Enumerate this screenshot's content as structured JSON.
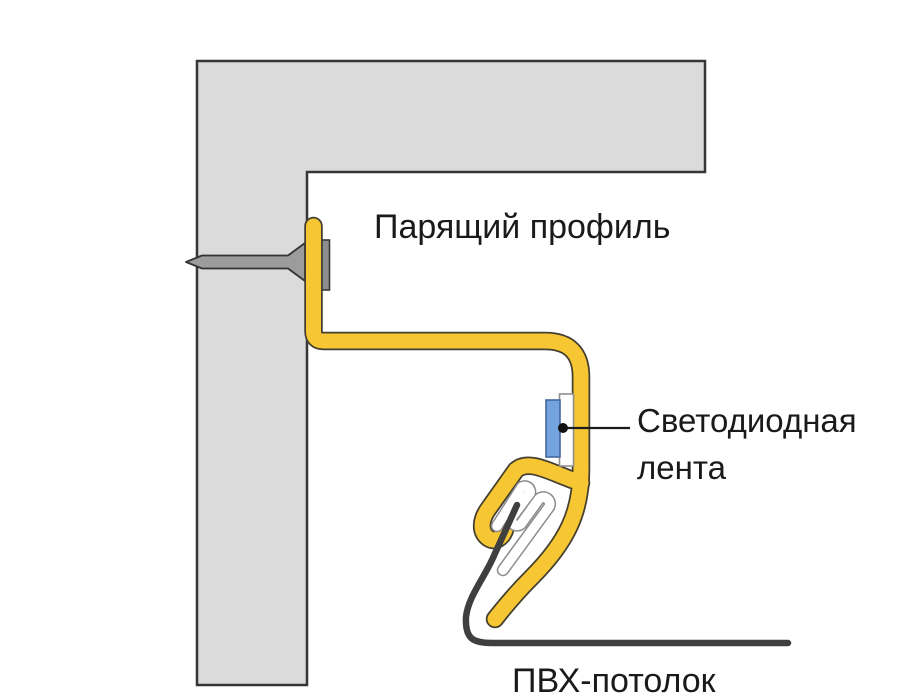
{
  "diagram": {
    "labels": {
      "floating_profile": "Парящий профиль",
      "led_strip_line1": "Светодиодная",
      "led_strip_line2": "лента",
      "pvc_ceiling": "ПВХ-потолок"
    },
    "colors": {
      "background": "#FFFFFF",
      "wall_fill": "#DBDBDB",
      "wall_outline": "#363636",
      "profile_yellow": "#F7C733",
      "profile_outline": "#443F30",
      "screw_gray": "#9C9C9C",
      "backing_plate_gray": "#8E8E8E",
      "led_blue": "#74A4E0",
      "led_blue_outline": "#44699C",
      "harpoon_white": "#FFFFFF",
      "harpoon_outline": "#8C8C8C",
      "pvc_film_dark": "#3F3F3F",
      "text": "#1A1A1A"
    }
  }
}
